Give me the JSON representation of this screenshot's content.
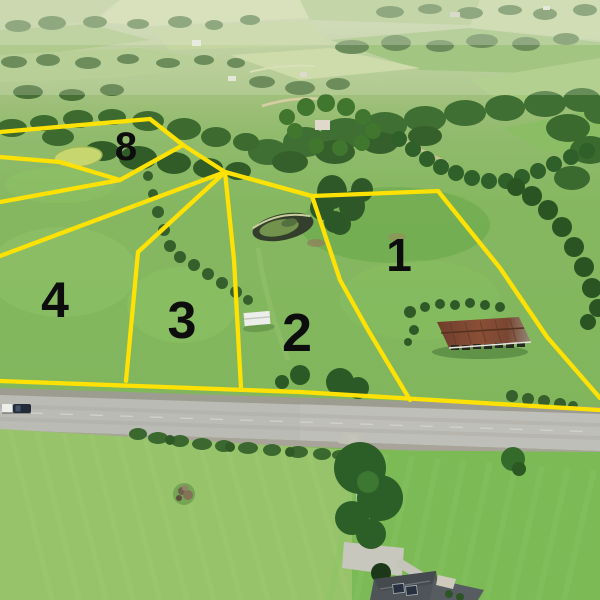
{
  "title": "Aerial lot map photograph",
  "lots": [
    {
      "id": "lot-1",
      "label": "1"
    },
    {
      "id": "lot-2",
      "label": "2"
    },
    {
      "id": "lot-3",
      "label": "3"
    },
    {
      "id": "lot-4",
      "label": "4"
    },
    {
      "id": "lot-8",
      "label": "8"
    }
  ],
  "palette": {
    "boundary_yellow": "#ffe103",
    "lot_number_black": "#0d0d0d",
    "road_gray": "#babbb5",
    "pasture_green": "#7db65a",
    "forest_green": "#3c6b2f",
    "haze_green": "#c9d3ac",
    "barn_roof_rust": "#7a4632",
    "shed_white": "#eceee9",
    "house_roof_gray": "#4f5459",
    "pond_dark": "#333f2c"
  },
  "features": {
    "road": "two-lane-road",
    "vehicle": "pickup-truck",
    "barn": "rusty-roof-barn",
    "shed": "white-shed",
    "pond": "farm-pond",
    "house": "house-with-solar-panels",
    "hay_field": "mowed-field",
    "forest": "tree-rows"
  }
}
